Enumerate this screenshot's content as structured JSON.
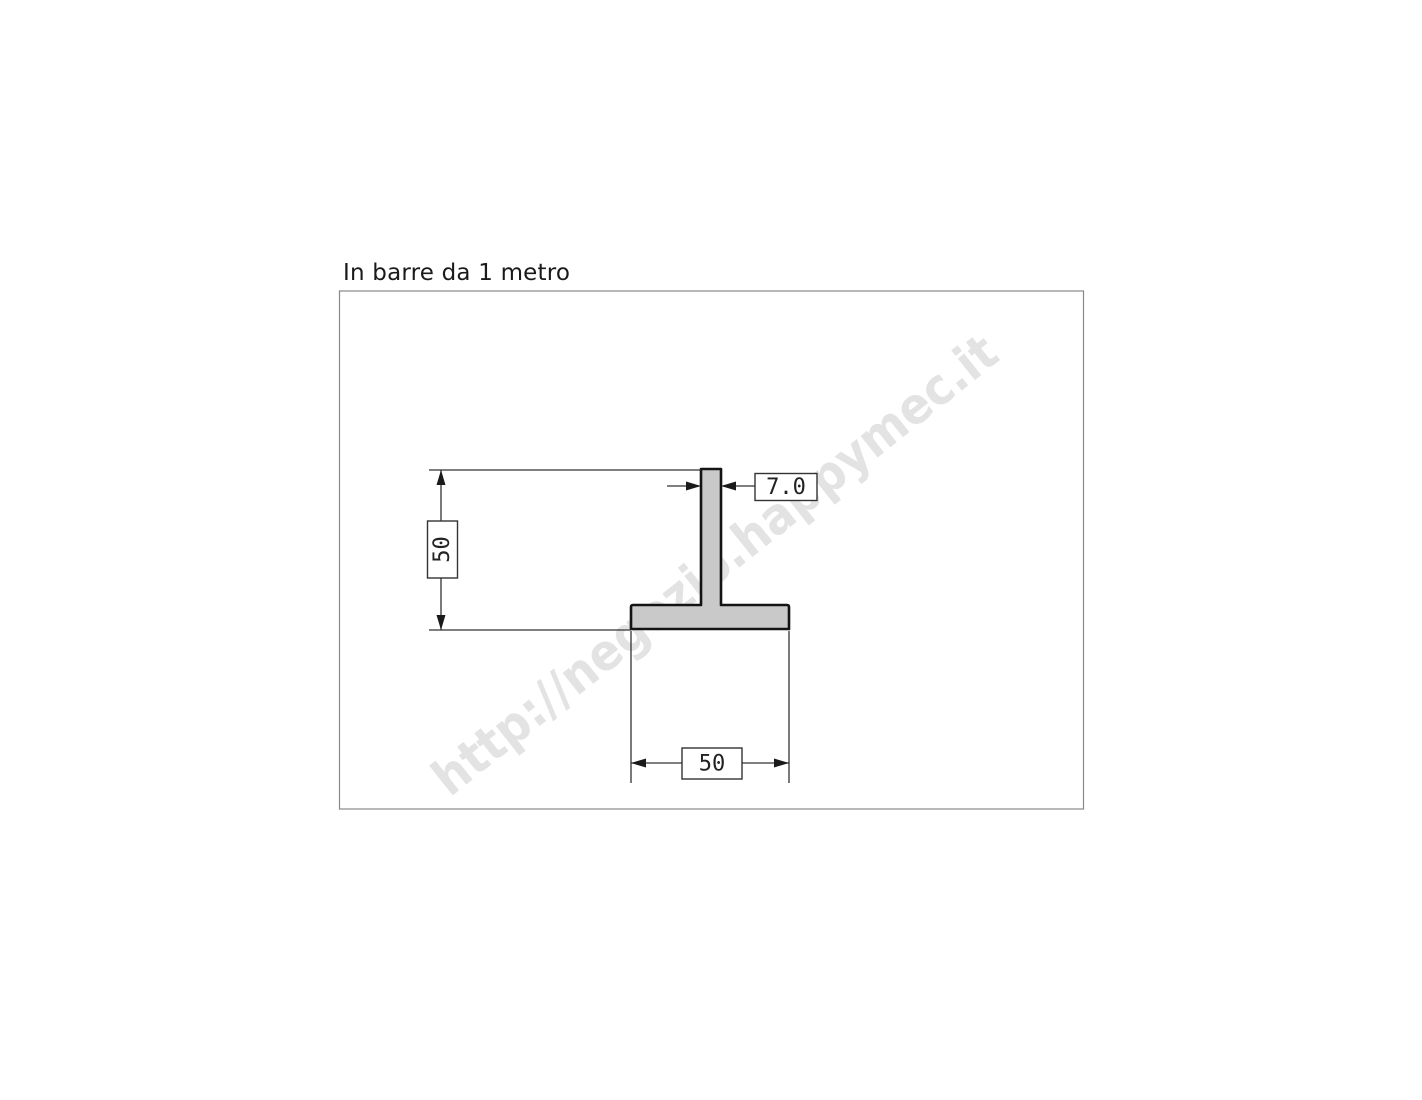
{
  "page": {
    "title": "In barre da 1 metro",
    "watermark_text": "http://negozio.happymec.it"
  },
  "drawing": {
    "labels": {
      "height": "50",
      "web_thickness": "7.0",
      "flange_width": "50"
    },
    "colors": {
      "profile_fill": "#c9c9c9",
      "outline": "#141414",
      "dimension_line": "#333333",
      "frame_border": "#888888",
      "watermark": "#e3e3e3"
    }
  }
}
